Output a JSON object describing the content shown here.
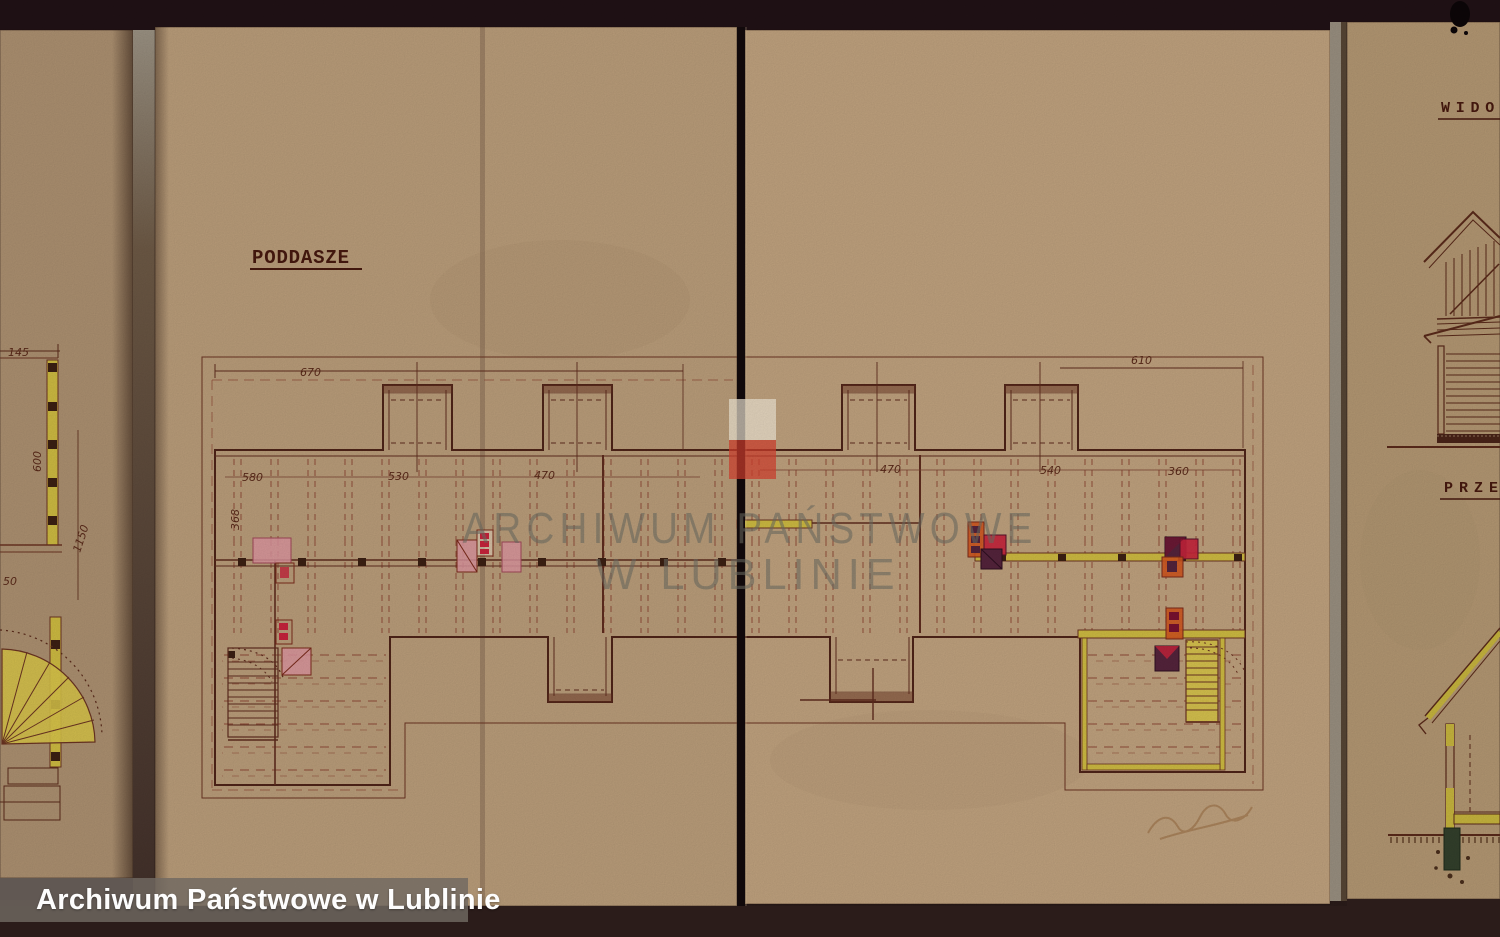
{
  "caption": {
    "text": "Archiwum Państwowe w Lublinie"
  },
  "watermark": {
    "line1": "ARCHIWUM PAŃSTWOWE",
    "line2": "W LUBLINIE",
    "flag_white": "#f2ead8",
    "flag_red": "#d8412f"
  },
  "main_sheet": {
    "title": "PODDASZE",
    "dims": {
      "d670": "670",
      "d610": "610",
      "d580": "580",
      "d530": "530",
      "d470a": "470",
      "d470b": "470",
      "d540": "540",
      "d360": "360",
      "d368": "368"
    }
  },
  "left_sheet": {
    "dims": {
      "d145": "145",
      "d600": "600",
      "d1150": "1150",
      "d50": "50"
    }
  },
  "right_sheet": {
    "label_view": "WIDOK",
    "label_section": "PRZE"
  },
  "colors": {
    "paper": "#bb9e7b",
    "ink": "#4f2418",
    "dash": "#8f4a36",
    "wall_yellow": "#cfbc42",
    "chimney_pink": "#dd96a0",
    "chimney_red": "#c8243c",
    "chimney_orange": "#d2571f",
    "chimney_purple": "#55243c",
    "foundation_green": "#33402c"
  }
}
